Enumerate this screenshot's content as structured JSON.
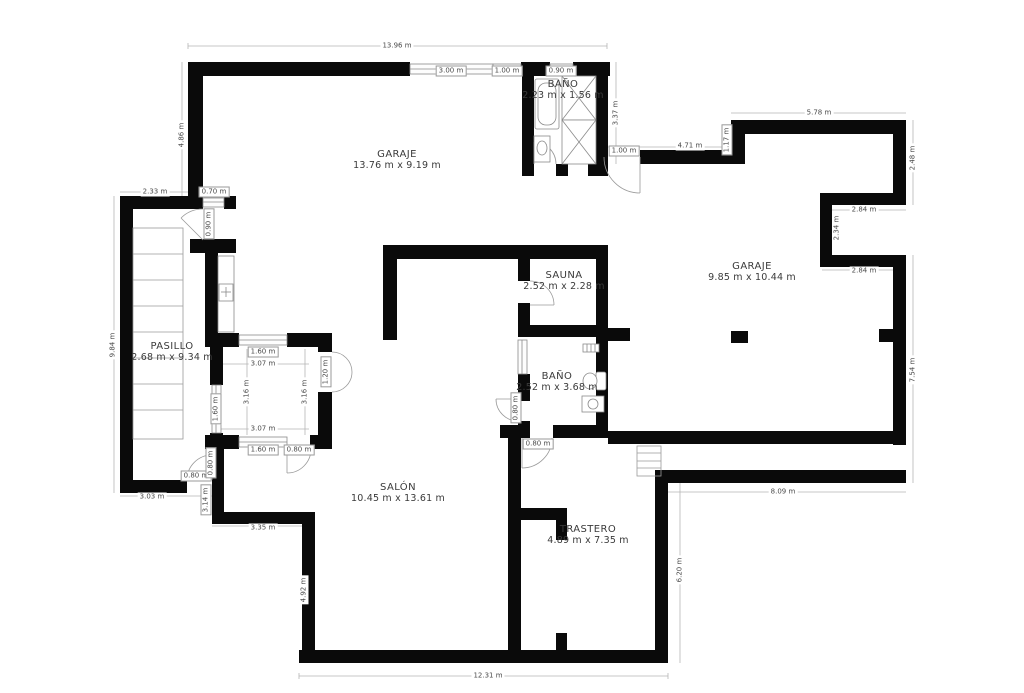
{
  "page": {
    "background": "#ffffff",
    "wall_color": "#0a0a0a",
    "line_color": "#b5b5b5"
  },
  "plan": {
    "rooms": [
      {
        "id": "garaje-1",
        "name": "GARAJE",
        "dims": "13.76 m x 9.19 m",
        "x": 397,
        "y": 160
      },
      {
        "id": "bano-1",
        "name": "BAÑO",
        "dims": "2.23 m x 1.56 m",
        "x": 563,
        "y": 90
      },
      {
        "id": "garaje-2",
        "name": "GARAJE",
        "dims": "9.85 m x 10.44 m",
        "x": 752,
        "y": 272
      },
      {
        "id": "sauna",
        "name": "SAUNA",
        "dims": "2.52 m x 2.28 m",
        "x": 564,
        "y": 281
      },
      {
        "id": "pasillo",
        "name": "PASILLO",
        "dims": "2.68 m x 9.34 m",
        "x": 172,
        "y": 352
      },
      {
        "id": "bano-2",
        "name": "BAÑO",
        "dims": "2.52 m x 3.68 m",
        "x": 557,
        "y": 382
      },
      {
        "id": "salon",
        "name": "SALÓN",
        "dims": "10.45 m x 13.61 m",
        "x": 398,
        "y": 493
      },
      {
        "id": "trastero",
        "name": "TRASTERO",
        "dims": "4.89 m x 7.35 m",
        "x": 588,
        "y": 535
      }
    ],
    "dimensions": [
      {
        "text": "13.96 m",
        "x": 397,
        "y": 46,
        "rot": 0,
        "boxed": false
      },
      {
        "text": "3.00 m",
        "x": 451,
        "y": 71,
        "rot": 0,
        "boxed": true
      },
      {
        "text": "1.00 m",
        "x": 507,
        "y": 71,
        "rot": 0,
        "boxed": true
      },
      {
        "text": "0.90 m",
        "x": 561,
        "y": 71,
        "rot": 0,
        "boxed": true
      },
      {
        "text": "4.86 m",
        "x": 182,
        "y": 135,
        "rot": 90,
        "boxed": false
      },
      {
        "text": "2.33 m",
        "x": 155,
        "y": 192,
        "rot": 0,
        "boxed": false
      },
      {
        "text": "0.70 m",
        "x": 214,
        "y": 192,
        "rot": 0,
        "boxed": true
      },
      {
        "text": "0.90 m",
        "x": 209,
        "y": 224,
        "rot": 90,
        "boxed": true
      },
      {
        "text": "9.84 m",
        "x": 113,
        "y": 345,
        "rot": 90,
        "boxed": false
      },
      {
        "text": "3.37 m",
        "x": 616,
        "y": 113,
        "rot": 90,
        "boxed": false
      },
      {
        "text": "1.00 m",
        "x": 624,
        "y": 151,
        "rot": 0,
        "boxed": true
      },
      {
        "text": "4.71 m",
        "x": 690,
        "y": 146,
        "rot": 0,
        "boxed": false
      },
      {
        "text": "1.17 m",
        "x": 727,
        "y": 140,
        "rot": 90,
        "boxed": true
      },
      {
        "text": "5.78 m",
        "x": 819,
        "y": 113,
        "rot": 0,
        "boxed": false
      },
      {
        "text": "2.48 m",
        "x": 913,
        "y": 158,
        "rot": 90,
        "boxed": false
      },
      {
        "text": "2.84 m",
        "x": 864,
        "y": 210,
        "rot": 0,
        "boxed": false
      },
      {
        "text": "2.34 m",
        "x": 837,
        "y": 228,
        "rot": 90,
        "boxed": false
      },
      {
        "text": "2.84 m",
        "x": 864,
        "y": 271,
        "rot": 0,
        "boxed": false
      },
      {
        "text": "7.54 m",
        "x": 913,
        "y": 370,
        "rot": 90,
        "boxed": false
      },
      {
        "text": "8.09 m",
        "x": 783,
        "y": 492,
        "rot": 0,
        "boxed": false
      },
      {
        "text": "6.20 m",
        "x": 680,
        "y": 570,
        "rot": 90,
        "boxed": false
      },
      {
        "text": "12.31 m",
        "x": 488,
        "y": 676,
        "rot": 0,
        "boxed": false
      },
      {
        "text": "4.92 m",
        "x": 304,
        "y": 590,
        "rot": 90,
        "boxed": false
      },
      {
        "text": "3.35 m",
        "x": 263,
        "y": 528,
        "rot": 0,
        "boxed": false
      },
      {
        "text": "3.14 m",
        "x": 206,
        "y": 500,
        "rot": 90,
        "boxed": true
      },
      {
        "text": "3.03 m",
        "x": 152,
        "y": 497,
        "rot": 0,
        "boxed": false
      },
      {
        "text": "0.80 m",
        "x": 196,
        "y": 476,
        "rot": 0,
        "boxed": true
      },
      {
        "text": "0.80 m",
        "x": 211,
        "y": 463,
        "rot": 90,
        "boxed": true
      },
      {
        "text": "1.60 m",
        "x": 263,
        "y": 352,
        "rot": 0,
        "boxed": true
      },
      {
        "text": "3.07 m",
        "x": 263,
        "y": 364,
        "rot": 0,
        "boxed": false
      },
      {
        "text": "3.16 m",
        "x": 247,
        "y": 392,
        "rot": 90,
        "boxed": false
      },
      {
        "text": "3.16 m",
        "x": 305,
        "y": 392,
        "rot": 90,
        "boxed": false
      },
      {
        "text": "3.07 m",
        "x": 263,
        "y": 429,
        "rot": 0,
        "boxed": false
      },
      {
        "text": "1.60 m",
        "x": 263,
        "y": 450,
        "rot": 0,
        "boxed": true
      },
      {
        "text": "0.80 m",
        "x": 299,
        "y": 450,
        "rot": 0,
        "boxed": true
      },
      {
        "text": "1.60 m",
        "x": 216,
        "y": 409,
        "rot": 90,
        "boxed": true
      },
      {
        "text": "1.20 m",
        "x": 326,
        "y": 372,
        "rot": 90,
        "boxed": true
      },
      {
        "text": "0.80 m",
        "x": 516,
        "y": 408,
        "rot": 90,
        "boxed": true
      },
      {
        "text": "0.80 m",
        "x": 538,
        "y": 444,
        "rot": 0,
        "boxed": true
      }
    ]
  }
}
